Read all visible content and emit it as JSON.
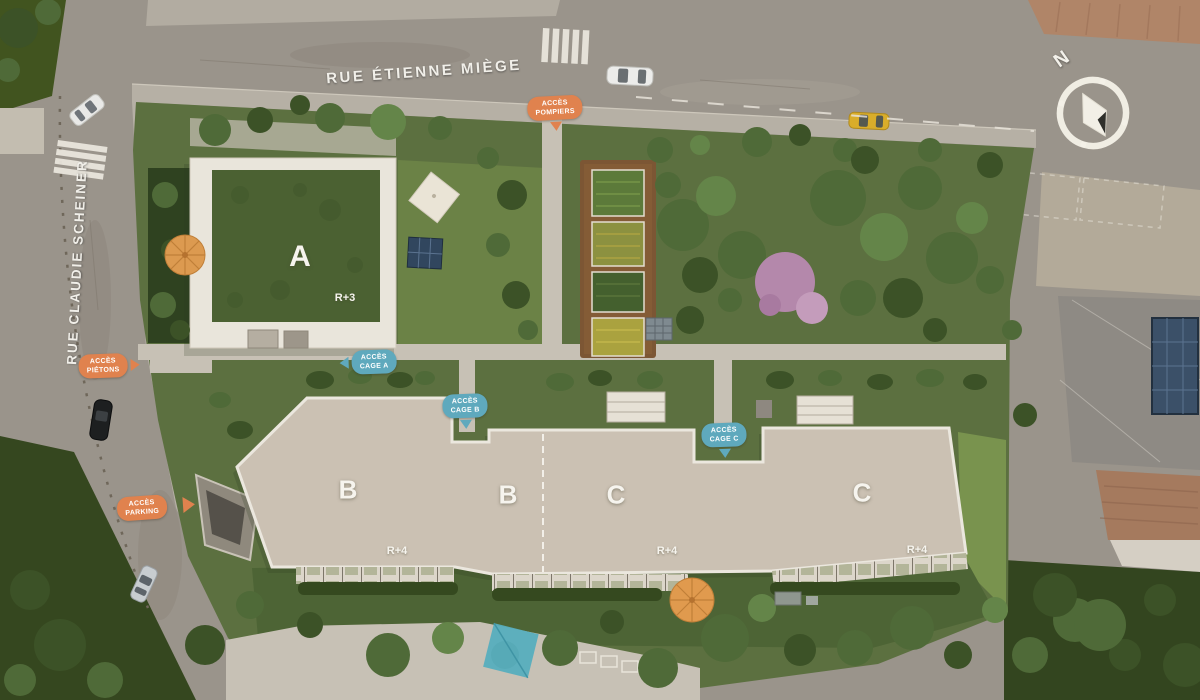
{
  "streets": {
    "top": "RUE ÉTIENNE MIÈGE",
    "left": "RUE CLAUDIE SCHEINER"
  },
  "buildings": [
    {
      "letter": "A",
      "floors": "R+3"
    },
    {
      "letter": "B",
      "floors": "R+4"
    },
    {
      "letter": "B",
      "floors": ""
    },
    {
      "letter": "C",
      "floors": "R+4"
    },
    {
      "letter": "C",
      "floors": "R+4"
    }
  ],
  "badges": [
    {
      "line1": "ACCÈS",
      "line2": "POMPIERS",
      "type": "orange",
      "arrow": "down"
    },
    {
      "line1": "ACCÈS",
      "line2": "PIÉTONS",
      "type": "orange",
      "arrow": "right"
    },
    {
      "line1": "ACCÈS",
      "line2": "PARKING",
      "type": "orange",
      "arrow": "right"
    },
    {
      "line1": "ACCÈS",
      "line2": "CAGE A",
      "type": "blue",
      "arrow": "left"
    },
    {
      "line1": "ACCÈS",
      "line2": "CAGE B",
      "type": "blue",
      "arrow": "down"
    },
    {
      "line1": "ACCÈS",
      "line2": "CAGE C",
      "type": "blue",
      "arrow": "down"
    }
  ],
  "compass": {
    "north_label": "N"
  },
  "colors": {
    "access_orange": "#e0824e",
    "access_blue": "#5fa9bd",
    "roof_beige": "#cbc1b3",
    "green_roof": "#4b6132",
    "lawn": "#5c7040",
    "road": "#9a948b"
  }
}
